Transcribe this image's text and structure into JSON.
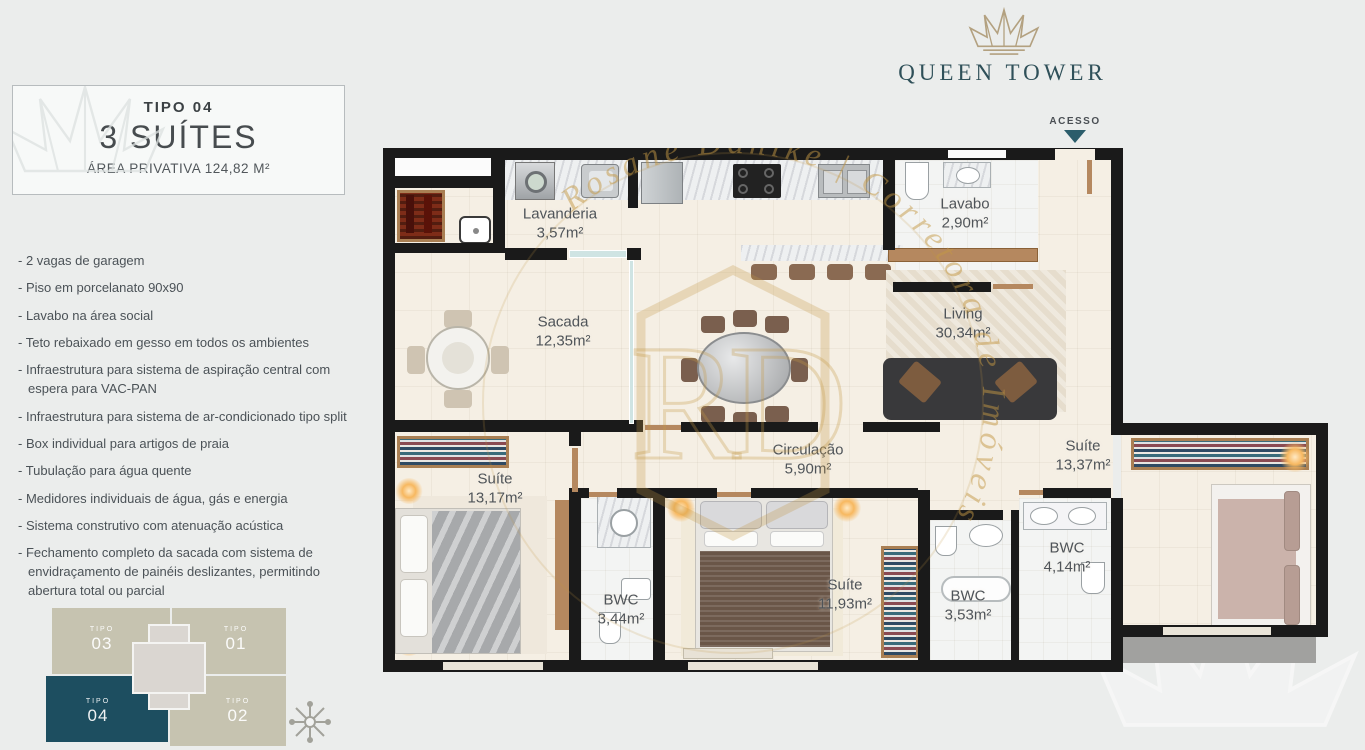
{
  "brand": {
    "name": "QUEEN TOWER",
    "crown_color": "#b3a180",
    "text_color": "#2f5059"
  },
  "access": {
    "label": "ACESSO",
    "arrow_color": "#2b5d6b"
  },
  "unit_card": {
    "tipo": "TIPO 04",
    "title": "3 SUÍTES",
    "area_line": "ÁREA PRIVATIVA 124,82 M²"
  },
  "features": [
    "2 vagas de garagem",
    "Piso em porcelanato 90x90",
    "Lavabo na área social",
    "Teto rebaixado em gesso em todos os ambientes",
    "Infraestrutura para sistema de aspiração central com espera para VAC-PAN",
    "Infraestrutura para sistema de ar-condicionado tipo split",
    "Box individual para artigos de praia",
    "Tubulação para água quente",
    "Medidores individuais de água, gás e energia",
    "Sistema construtivo com atenuação acústica",
    "Fechamento completo da sacada com sistema de envidraçamento de painéis deslizantes, permitindo abertura total ou parcial"
  ],
  "floorplan": {
    "rooms": [
      {
        "name": "Lavanderia",
        "area": "3,57m²"
      },
      {
        "name": "Lavabo",
        "area": "2,90m²"
      },
      {
        "name": "Living",
        "area": "30,34m²"
      },
      {
        "name": "Sacada",
        "area": "12,35m²"
      },
      {
        "name": "Circulação",
        "area": "5,90m²"
      },
      {
        "name": "Suíte",
        "area": "13,17m²"
      },
      {
        "name": "BWC",
        "area": "3,44m²"
      },
      {
        "name": "Suíte",
        "area": "11,93m²"
      },
      {
        "name": "BWC",
        "area": "3,53m²"
      },
      {
        "name": "BWC",
        "area": "4,14m²"
      },
      {
        "name": "Suíte",
        "area": "13,37m²"
      }
    ],
    "colors": {
      "wall": "#1a1a1a",
      "floor": "#f5efe4",
      "glass": "#cfe4e3",
      "wood": "#b5885f",
      "ledge": "#a1a19f"
    },
    "watermark": {
      "text": "Rosane Dahlke | Corretora de Imóveis",
      "monogram": "RD",
      "color": "#c39844"
    }
  },
  "keyplan": {
    "units": [
      {
        "tipo": "TIPO",
        "num": "03",
        "highlighted": false
      },
      {
        "tipo": "TIPO",
        "num": "01",
        "highlighted": false
      },
      {
        "tipo": "TIPO",
        "num": "04",
        "highlighted": true
      },
      {
        "tipo": "TIPO",
        "num": "02",
        "highlighted": false
      }
    ],
    "highlight_color": "#1d4e60",
    "block_color": "#c6c3b0",
    "core_color": "#dad6d1"
  }
}
